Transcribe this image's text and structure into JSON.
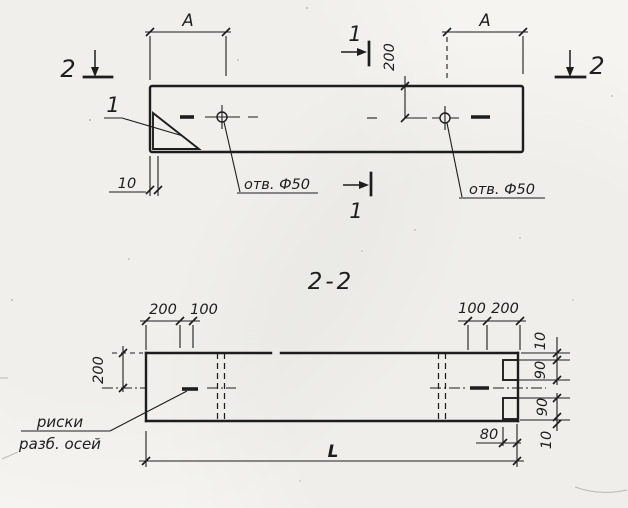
{
  "plan": {
    "marker_2_left": "2",
    "marker_2_right": "2",
    "marker_1_top": "1",
    "marker_1_bottom": "1",
    "corner_detail_mark": "1",
    "dim_a_left": "A",
    "dim_a_right": "A",
    "dim_hole_offset": "200",
    "dim_edge_gap": "10",
    "hole_label_left": "отв. Ф50",
    "hole_label_right": "отв. Ф50"
  },
  "section": {
    "title": "2-2",
    "dim_left_outer": "200",
    "dim_left_inner": "100",
    "dim_right_inner": "100",
    "dim_right_outer": "200",
    "dim_side_offset": "200",
    "chain": {
      "top_10": "10",
      "top_90": "90",
      "bottom_90": "90",
      "bottom_10": "10"
    },
    "dim_notch_depth": "80",
    "dim_length": "L",
    "note_line1": "риски",
    "note_line2": "разб. осей"
  },
  "colors": {
    "paper": "#f5f4f0",
    "ink": "#1d1d1d"
  }
}
